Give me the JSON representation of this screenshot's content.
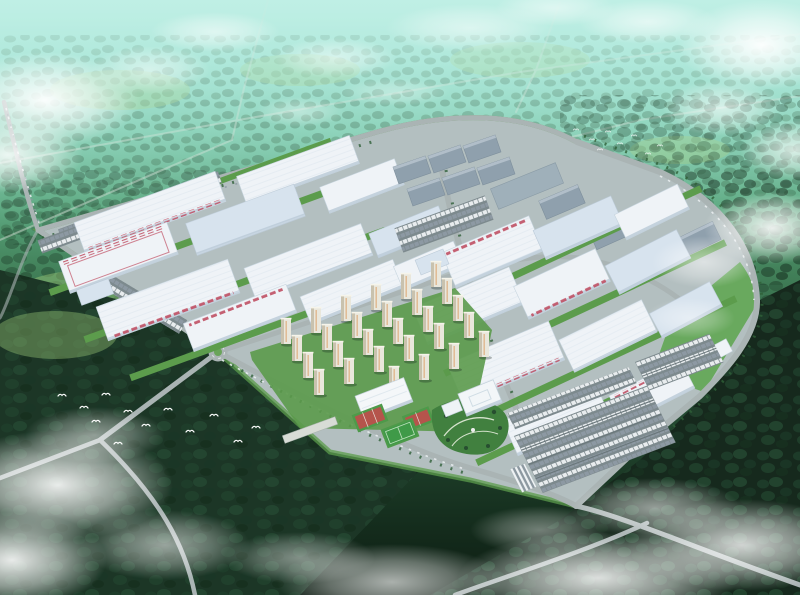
{
  "meta": {
    "title": "Aerial bird's-eye rendering of a large industrial manufacturing campus surrounded by forest",
    "media_type": "architectural aerial rendering",
    "dimensions": "800x595"
  },
  "palette": {
    "sky-haze": "#a7e7dc",
    "far-forest": "#3b6f4d",
    "near-forest": "#1c3626",
    "field-light": "#9cc878",
    "campus-green": "#5c9c4c",
    "lawn": "#61a653",
    "roof-white": "#eff3f7",
    "roof-blue": "#d7e3ee",
    "roof-shadow": "#bccbd8",
    "roof-gray": "#8fa0ad",
    "accent-red": "#c05064",
    "road": "#aab4b4",
    "road-dark": "#707c80",
    "asphalt": "#7d8a8e",
    "court-red": "#b5544c",
    "pitch-green": "#3f9a48",
    "tower-face": "#e9e7dc",
    "tower-side": "#c9c2ae",
    "tower-accent": "#d98f4f",
    "cloud": "#ffffff",
    "car-light": "#e8ecee",
    "car-dark": "#8d99a3"
  },
  "scene": {
    "labels": {
      "farForest": "hazy distant forest with clearings and faint country roads",
      "haze": "cyan atmospheric haze over the horizon",
      "nearForest": "dark dense forest in the foreground",
      "fields": "light green meadow clearings",
      "farRoads": "faint rural roads crossing the forest",
      "campus": "diamond-shaped industrial park campus",
      "westBlock": "western block of white factory halls with red truck docks",
      "northWarehouses": "cluster of six gray warehouses on the north edge",
      "eastWarehouses": "gray warehouses along the north-east perimeter",
      "eastBlock": "eastern block of large white factory halls",
      "residential": "staff residential quarter with rows of apartment towers",
      "sports": "sports area with gymnasium, red courts and a green pitch",
      "officePark": "office building with landscaped garden",
      "parking": "large staff parking lots filled with cars",
      "lawn": "open lawn inside the eastern perimeter",
      "roads": "perimeter and access roads with traffic",
      "roundabout": "roundabout at the south-west campus entrance",
      "birds": "flock of white birds flying over the forest",
      "clouds": "white clouds and mist drifting over the scene"
    },
    "counts": {
      "north_warehouses": 6,
      "east_gray_warehouses": 3,
      "residential_towers": 28,
      "sport_court_clusters": 2,
      "soccer_fields": 1,
      "roundabouts": 1
    }
  }
}
